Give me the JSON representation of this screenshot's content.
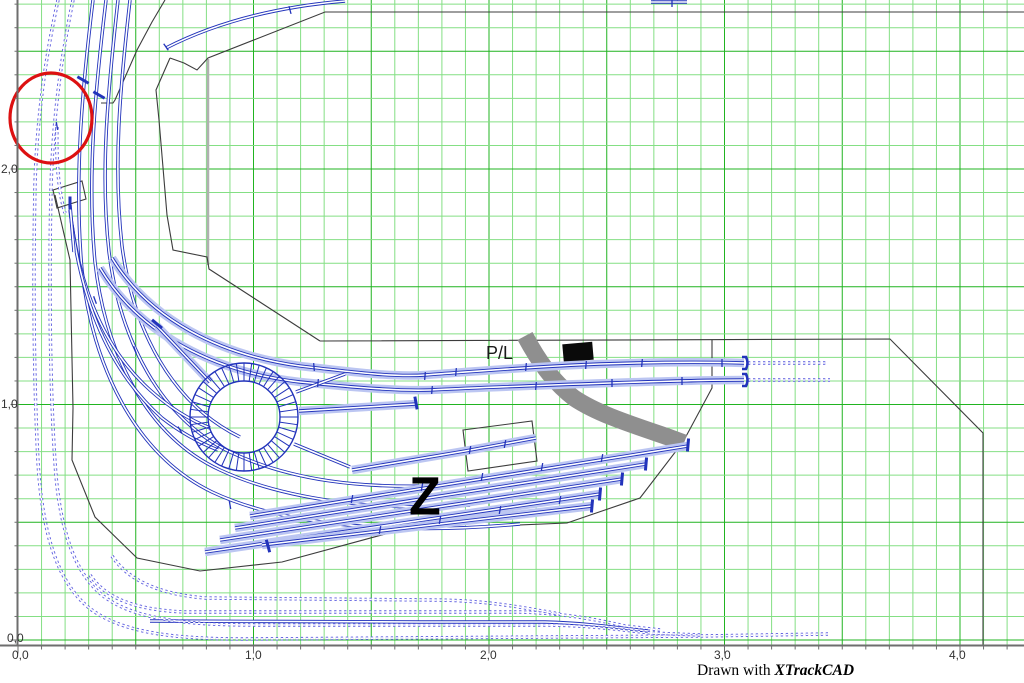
{
  "caption": {
    "prefix": "Drawn with ",
    "brand": "XTrackCAD"
  },
  "labels": {
    "pl": "P/L",
    "z": "Z"
  },
  "axis": {
    "x_labels": [
      {
        "text": "0,0",
        "x": 12,
        "y": 649
      },
      {
        "text": "1,0",
        "x": 245,
        "y": 649
      },
      {
        "text": "2,0",
        "x": 480,
        "y": 649
      },
      {
        "text": "3,0",
        "x": 714,
        "y": 649
      },
      {
        "text": "4,0",
        "x": 949,
        "y": 649
      }
    ],
    "y_labels": [
      {
        "text": "2,0",
        "x": 1,
        "y": 163
      },
      {
        "text": "1,0",
        "x": 1,
        "y": 398
      },
      {
        "text": "0,0",
        "x": 7,
        "y": 632
      }
    ]
  },
  "colors": {
    "grid_minor": "#84df84",
    "grid_major": "#21b421",
    "ruler": "#6e6e6e",
    "outline": "#3c3c3c",
    "rail_solid": "#2233bb",
    "rail_dotted": "#5c5cdf",
    "highlight": "#bcc6f2",
    "road": "#8f8f8f",
    "marker": "#0a0a0a",
    "annotation_red": "#dd1111",
    "wall_gray": "#b0b0b0"
  },
  "grid": {
    "x0": 18,
    "y0": 640,
    "step": 23.55,
    "cols": 43,
    "rows": 28,
    "bottom": 645.5,
    "left": 17.5
  },
  "drawing": {
    "outline": [
      "M165,0 L152,22 L137,50 L115,100 L113,103 L101,103",
      "M170,58 L184,63 L197,70 L208,58 L325,12 L1026,12",
      "M170,58 L156,90 L159,120 L167,215 L173,250 L207,257 L209,269 L320,341",
      "M320,341 L890,339 L983,433 L983,646",
      "M55,195 L70,260 L73,408 L72,460 L95,517 L137,558 L200,571 L282,562 L400,530 L567,523 L640,498 L683,442 L712,388 L712,340",
      "M53,190 L82,181 L86,199 L57,208 Z",
      "M463,430 L532,421 L537,461 L468,471 Z"
    ],
    "gray_wall": "M208,59 L208,265",
    "road": "M525,336 C538,360 552,381 574,398 C598,414 630,424 668,437 L684,443",
    "marker_rect": {
      "x": 563,
      "y": 343,
      "w": 30,
      "h": 18,
      "rot": -5
    },
    "red_circle": {
      "cx": 51,
      "cy": 118,
      "rx": 41,
      "ry": 45
    },
    "turntable": {
      "cx": 244,
      "cy": 417,
      "r_outer": 54,
      "r_inner": 36,
      "spokes": 44
    },
    "tracks": [
      {
        "d": "M166,48 Q240,10 345,1",
        "dot": false,
        "h": false
      },
      {
        "d": "M651,2 L687,2",
        "dot": false,
        "h": false
      },
      {
        "d": "M93,0 C82,90 74,180 82,270 C92,365 135,455 212,492 C280,524 390,536 520,524",
        "dot": false,
        "h": false
      },
      {
        "d": "M106,0 C95,92 87,178 95,262 C105,352 146,436 220,470 C285,500 380,512 470,505",
        "dot": false,
        "h": false
      },
      {
        "d": "M118,0 C108,90 100,172 109,252 C120,340 160,418 230,452 C290,480 360,490 455,485",
        "dot": false,
        "h": false
      },
      {
        "d": "M130,0 C120,88 113,165 122,246 C133,330 172,404 240,437",
        "dot": false,
        "h": false
      },
      {
        "d": "M70,210 C78,280 100,345 150,390 C170,408 190,420 210,428",
        "dot": false,
        "h": false
      },
      {
        "d": "M72,225 C82,300 108,370 162,418 C180,432 200,443 218,450",
        "dot": false,
        "h": false
      },
      {
        "d": "M70,205 L74,252",
        "dot": false,
        "h": false
      },
      {
        "d": "M112,258 C150,320 220,355 300,366 C360,373 395,377 425,375 C480,371 540,366 600,364 C660,362 710,362 744,363",
        "dot": false,
        "h": true
      },
      {
        "d": "M100,268 C140,335 215,372 300,382 C360,388 400,391 430,390 C490,387 550,385 610,383 C670,381 715,380 744,380",
        "dot": false,
        "h": true
      },
      {
        "d": "M157,326 L210,382",
        "dot": false,
        "h": true
      },
      {
        "d": "M299,411 L416,404",
        "dot": false,
        "h": true
      },
      {
        "d": "M296,392 L345,374",
        "dot": false,
        "h": false
      },
      {
        "d": "M294,444 L350,467",
        "dot": false,
        "h": false
      },
      {
        "d": "M352,470 C400,462 430,457 465,451 L536,438",
        "dot": false,
        "h": true
      },
      {
        "d": "M250,516 L688,446",
        "dot": false,
        "h": true
      },
      {
        "d": "M235,528 L646,464",
        "dot": false,
        "h": true
      },
      {
        "d": "M220,540 L622,479",
        "dot": false,
        "h": true
      },
      {
        "d": "M205,552 L600,494",
        "dot": false,
        "h": true
      },
      {
        "d": "M262,545 L592,506",
        "dot": false,
        "h": true
      },
      {
        "d": "M150,621 C230,622 320,622 420,622 L545,622 C583,623 613,627 648,631",
        "dot": false,
        "h": false
      },
      {
        "d": "M58,0 C46,55 37,115 35,185 C33,285 34,385 38,462 C42,530 56,580 88,607 C120,633 175,639 245,639 L700,636 L828,634",
        "dot": true,
        "h": false
      },
      {
        "d": "M73,0 C61,58 53,118 51,188 C49,288 50,388 55,462 C59,528 74,572 102,595 C132,619 185,625 255,625 L540,625 C585,625 615,629 650,633 L700,635",
        "dot": true,
        "h": false
      },
      {
        "d": "M90,575 C105,598 135,610 185,612 L520,612 C558,613 590,618 625,626 L660,630",
        "dot": true,
        "h": false
      },
      {
        "d": "M112,556 C128,580 158,594 205,598 L430,600 C465,600 495,603 525,608 L560,614",
        "dot": true,
        "h": false
      },
      {
        "d": "M57,127 C56,165 59,193 65,213",
        "dot": true,
        "h": false
      },
      {
        "d": "M748,363 L826,363",
        "dot": true,
        "h": false
      },
      {
        "d": "M748,380 L830,380",
        "dot": true,
        "h": false
      }
    ],
    "ticks_bold": [
      [
        83,
        80,
        30
      ],
      [
        99,
        95,
        30
      ],
      [
        70,
        203,
        90
      ],
      [
        157,
        324,
        40
      ],
      [
        268,
        546,
        75
      ],
      [
        416,
        403,
        80
      ],
      [
        688,
        445,
        95
      ],
      [
        646,
        464,
        95
      ],
      [
        622,
        479,
        95
      ],
      [
        600,
        494,
        95
      ],
      [
        592,
        506,
        95
      ]
    ],
    "ticks_small": [
      [
        166,
        47,
        55
      ],
      [
        290,
        10,
        75
      ],
      [
        672,
        3,
        90
      ],
      [
        57,
        126,
        80
      ],
      [
        95,
        300,
        70
      ],
      [
        314,
        367,
        85
      ],
      [
        425,
        376,
        95
      ],
      [
        456,
        372,
        95
      ],
      [
        526,
        367,
        95
      ],
      [
        586,
        365,
        95
      ],
      [
        642,
        363,
        95
      ],
      [
        722,
        363,
        90
      ],
      [
        318,
        383,
        95
      ],
      [
        432,
        390,
        95
      ],
      [
        536,
        386,
        95
      ],
      [
        612,
        383,
        90
      ],
      [
        682,
        381,
        90
      ],
      [
        352,
        499,
        100
      ],
      [
        422,
        487,
        100
      ],
      [
        482,
        477,
        100
      ],
      [
        542,
        467,
        100
      ],
      [
        602,
        458,
        100
      ],
      [
        470,
        450,
        100
      ],
      [
        505,
        444,
        100
      ],
      [
        380,
        530,
        100
      ],
      [
        440,
        520,
        100
      ],
      [
        500,
        510,
        100
      ],
      [
        560,
        500,
        100
      ],
      [
        135,
        350,
        70
      ],
      [
        180,
        430,
        60
      ],
      [
        230,
        505,
        80
      ]
    ],
    "bumpers": [
      [
        746,
        363
      ],
      [
        746,
        380
      ]
    ]
  }
}
